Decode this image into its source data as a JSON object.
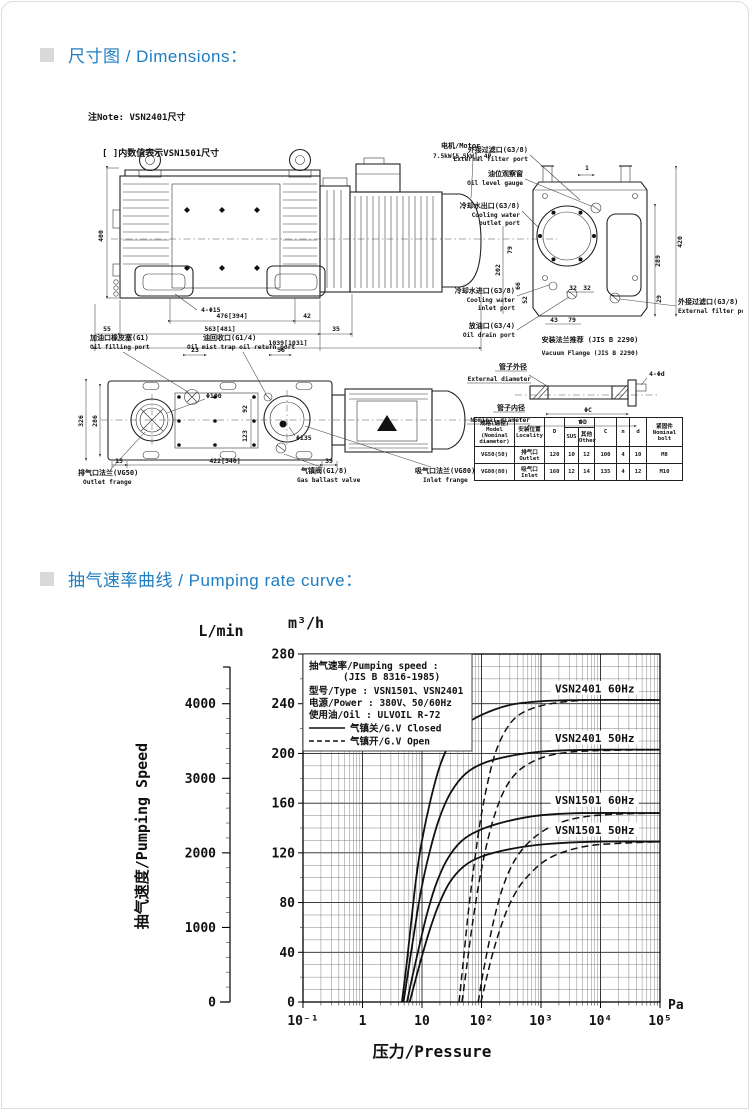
{
  "page": {
    "accent_blue": "#1d7dc2",
    "bullet_gray": "#d9d9d9",
    "line_color": "#111111"
  },
  "sections": {
    "dimensions": {
      "title": "尺寸图 / Dimensions：",
      "note1": "注Note: VSN2401尺寸",
      "note2": "[ ]内数值表示VSN1501尺寸"
    },
    "curve": {
      "title": "抽气速率曲线 / Pumping rate curve："
    }
  },
  "drawing": {
    "side_view": {
      "motor_zh": "电机/Motor",
      "motor_spec": "7.5kW[5.5kW]、4P",
      "dim_height": "400",
      "dim_bolt": "4-Φ15",
      "dim_w1": "476[394]",
      "dim_w2": "42",
      "dim_w3": "55",
      "dim_w4": "563[481]",
      "dim_w5": "35",
      "dim_total": "1039[1031]"
    },
    "end_view": {
      "ext_filter_top_zh": "外接过滤口(G3/8)",
      "ext_filter_top_en": "External filter port",
      "oil_gauge_zh": "油位观察窗",
      "oil_gauge_en": "Oil level gauge",
      "cool_out_zh": "冷却水出口(G3/8)",
      "cool_out_en1": "Cooling water",
      "cool_out_en2": "outlet port",
      "cool_in_zh": "冷却水进口(G3/8)",
      "cool_in_en1": "Cooling water",
      "cool_in_en2": "inlet port",
      "oil_drain_zh": "放油口(G3/4)",
      "oil_drain_en": "Oil drain port",
      "ext_filter_bot_zh": "外接过滤口(G3/8)",
      "ext_filter_bot_en": "External filter port",
      "dim_420": "420",
      "dim_289": "289",
      "dim_202": "202",
      "dim_79a": "79",
      "dim_66": "66",
      "dim_52": "52",
      "dim_29": "29",
      "dim_1": "1",
      "dim_32a": "32",
      "dim_32b": "32",
      "dim_43": "43",
      "dim_79b": "79"
    },
    "top_view": {
      "oil_fill_zh": "加油口橡皮塞(G1)",
      "oil_fill_en": "Oil filling port",
      "oil_return_zh": "油回收口(G1/4)",
      "oil_return_en": "Oil mist trap oil return port",
      "outlet_zh": "排气口法兰(VG50)",
      "outlet_en": "Outlet frange",
      "ballast_zh": "气镇阀(G1/8)",
      "ballast_en": "Gas ballast valve",
      "inlet_zh": "吸气口法兰(VG80)",
      "inlet_en": "Inlet frange",
      "dim_23": "23",
      "dim_56": "56",
      "dim_286": "286",
      "dim_326": "326",
      "dim_d100": "Φ100",
      "dim_d135": "Φ135",
      "dim_92": "92",
      "dim_123": "123",
      "dim_15": "15",
      "dim_w": "422[340]",
      "dim_39": "39"
    },
    "flange": {
      "title_zh": "安装法兰推荐 (JIS B 2290)",
      "title_en": "Vacuum Flange (JIS B 2290)",
      "ext_zh": "管子外径",
      "ext_en": "External diameter",
      "nom_zh": "管子内径",
      "nom_en": "Nominal diameter",
      "bolt_label": "4-Φd",
      "c_label": "ΦC",
      "d_label": "ΦD",
      "table": {
        "h_model": "规格(通径)\nModel\n(Nominal\ndiameter)",
        "h_loc": "安装位置\nLocality",
        "h_d": "D",
        "h_t": "T",
        "h_sus": "SUS",
        "h_other": "其他\nOther",
        "h_c": "C",
        "h_n": "n",
        "h_dd": "d",
        "h_bolt": "紧固件\nNominal bolt",
        "rows": [
          [
            "VG50(50)",
            "排气口\nOutlet",
            "120",
            "10",
            "12",
            "100",
            "4",
            "10",
            "M8"
          ],
          [
            "VG80(80)",
            "吸气口\nInlet",
            "160",
            "12",
            "14",
            "135",
            "4",
            "12",
            "M10"
          ]
        ]
      }
    }
  },
  "chart_data": {
    "type": "line",
    "title": "抽气速率/Pumping speed : (JIS B 8316-1985)",
    "x_axis": {
      "scale": "log",
      "min_exp": -1,
      "max_exp": 5,
      "unit": "Pa",
      "tick_labels": [
        "10⁻¹",
        "1",
        "10",
        "10²",
        "10³",
        "10⁴",
        "10⁵"
      ],
      "label": "压力/Pressure"
    },
    "y_axis_m3h": {
      "unit": "m³/h",
      "min": 0,
      "max": 280,
      "label_step": 40,
      "grid_step": 10
    },
    "y_axis_lmin": {
      "unit": "L/min",
      "ticks": [
        0,
        1000,
        2000,
        3000,
        4000
      ],
      "minor_step": 200,
      "lmin_per_m3h": 16.6667
    },
    "y_label": "抽气速度/Pumping Speed",
    "legend": {
      "l1": "抽气速率/Pumping speed :",
      "l2": "(JIS B 8316-1985)",
      "l3": "型号/Type : VSN1501、VSN2401",
      "l4": "电源/Power : 380V、50/60Hz",
      "l5": "使用油/Oil : ULVOIL R-72",
      "solid": "气镇关/G.V Closed",
      "dashed": "气镇开/G.V Open"
    },
    "series": [
      {
        "name": "VSN2401 60Hz G.V Closed",
        "style": "solid",
        "points": [
          [
            4.6,
            0
          ],
          [
            5.5,
            30
          ],
          [
            6.5,
            62
          ],
          [
            8,
            100
          ],
          [
            10,
            130
          ],
          [
            14,
            163
          ],
          [
            20,
            190
          ],
          [
            30,
            209
          ],
          [
            50,
            222
          ],
          [
            100,
            231
          ],
          [
            300,
            239
          ],
          [
            1000,
            242
          ],
          [
            5000,
            243
          ],
          [
            100000,
            243
          ]
        ]
      },
      {
        "name": "VSN2401 50Hz G.V Closed",
        "style": "solid",
        "points": [
          [
            4.9,
            0
          ],
          [
            6,
            28
          ],
          [
            7.5,
            58
          ],
          [
            9.5,
            88
          ],
          [
            13,
            118
          ],
          [
            19,
            146
          ],
          [
            30,
            168
          ],
          [
            55,
            184
          ],
          [
            120,
            193
          ],
          [
            400,
            199
          ],
          [
            1500,
            202
          ],
          [
            10000,
            203
          ],
          [
            100000,
            203
          ]
        ]
      },
      {
        "name": "VSN1501 60Hz G.V Closed",
        "style": "solid",
        "points": [
          [
            5.6,
            0
          ],
          [
            7,
            22
          ],
          [
            9,
            45
          ],
          [
            12,
            70
          ],
          [
            17,
            94
          ],
          [
            26,
            114
          ],
          [
            45,
            129
          ],
          [
            90,
            138
          ],
          [
            250,
            145
          ],
          [
            900,
            150
          ],
          [
            5000,
            152
          ],
          [
            100000,
            152
          ]
        ]
      },
      {
        "name": "VSN1501 50Hz G.V Closed",
        "style": "solid",
        "points": [
          [
            6.2,
            0
          ],
          [
            7.8,
            18
          ],
          [
            10,
            37
          ],
          [
            13.5,
            58
          ],
          [
            19,
            78
          ],
          [
            29,
            96
          ],
          [
            50,
            109
          ],
          [
            100,
            117
          ],
          [
            300,
            123
          ],
          [
            1200,
            127
          ],
          [
            8000,
            129
          ],
          [
            100000,
            129
          ]
        ]
      },
      {
        "name": "VSN2401 60Hz G.V Open",
        "style": "dashed",
        "points": [
          [
            42,
            0
          ],
          [
            50,
            35
          ],
          [
            60,
            72
          ],
          [
            75,
            110
          ],
          [
            95,
            145
          ],
          [
            125,
            175
          ],
          [
            170,
            200
          ],
          [
            250,
            218
          ],
          [
            400,
            230
          ],
          [
            800,
            237
          ],
          [
            2000,
            241
          ],
          [
            8000,
            243
          ],
          [
            100000,
            243
          ]
        ]
      },
      {
        "name": "VSN2401 50Hz G.V Open",
        "style": "dashed",
        "points": [
          [
            47,
            0
          ],
          [
            57,
            30
          ],
          [
            70,
            62
          ],
          [
            90,
            95
          ],
          [
            120,
            125
          ],
          [
            165,
            150
          ],
          [
            240,
            170
          ],
          [
            380,
            184
          ],
          [
            700,
            193
          ],
          [
            1600,
            199
          ],
          [
            6000,
            202
          ],
          [
            100000,
            203
          ]
        ]
      },
      {
        "name": "VSN1501 60Hz G.V Open",
        "style": "dashed",
        "points": [
          [
            88,
            0
          ],
          [
            105,
            22
          ],
          [
            130,
            45
          ],
          [
            165,
            68
          ],
          [
            220,
            90
          ],
          [
            310,
            108
          ],
          [
            470,
            122
          ],
          [
            800,
            133
          ],
          [
            1600,
            142
          ],
          [
            4000,
            148
          ],
          [
            15000,
            151
          ],
          [
            100000,
            152
          ]
        ]
      },
      {
        "name": "VSN1501 50Hz G.V Open",
        "style": "dashed",
        "points": [
          [
            98,
            0
          ],
          [
            120,
            18
          ],
          [
            150,
            37
          ],
          [
            200,
            57
          ],
          [
            280,
            76
          ],
          [
            420,
            92
          ],
          [
            680,
            104
          ],
          [
            1200,
            114
          ],
          [
            2500,
            121
          ],
          [
            7000,
            126
          ],
          [
            30000,
            128
          ],
          [
            100000,
            129
          ]
        ]
      }
    ],
    "curve_labels": [
      {
        "text": "VSN2401 60Hz",
        "pa": 8000,
        "m3h": 252
      },
      {
        "text": "VSN2401 50Hz",
        "pa": 8000,
        "m3h": 212
      },
      {
        "text": "VSN1501 60Hz",
        "pa": 8000,
        "m3h": 162
      },
      {
        "text": "VSN1501 50Hz",
        "pa": 8000,
        "m3h": 138
      }
    ]
  }
}
